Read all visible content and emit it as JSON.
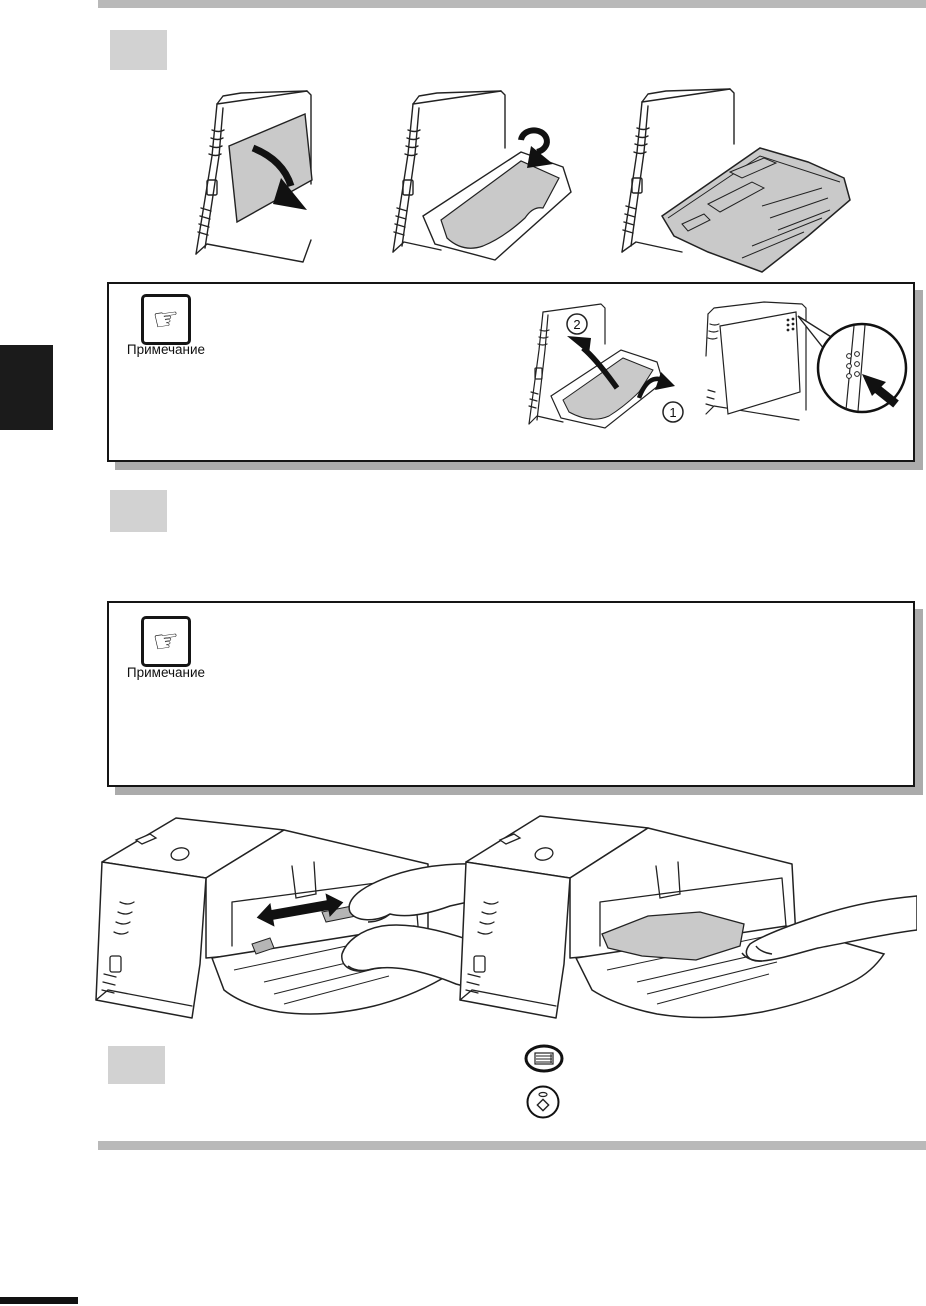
{
  "notes": [
    {
      "label": "Примечание",
      "icon": "pointing-hand-icon"
    },
    {
      "label": "Примечание",
      "icon": "pointing-hand-icon"
    }
  ],
  "figure_markers": {
    "fold_step_1": "1",
    "fold_step_2": "2"
  },
  "icons": {
    "note_glyph": "☞",
    "top_button": "multicopy-quantity-button-icon",
    "bottom_button": "start-button-icon"
  },
  "colors": {
    "rule_gray": "#b9b9b9",
    "step_box_gray": "#d2d2d2",
    "figure_gray": "#c9c9c9",
    "chapter_tab": "#1b1b1b",
    "note_shadow": "#ababab",
    "ink": "#222222"
  }
}
